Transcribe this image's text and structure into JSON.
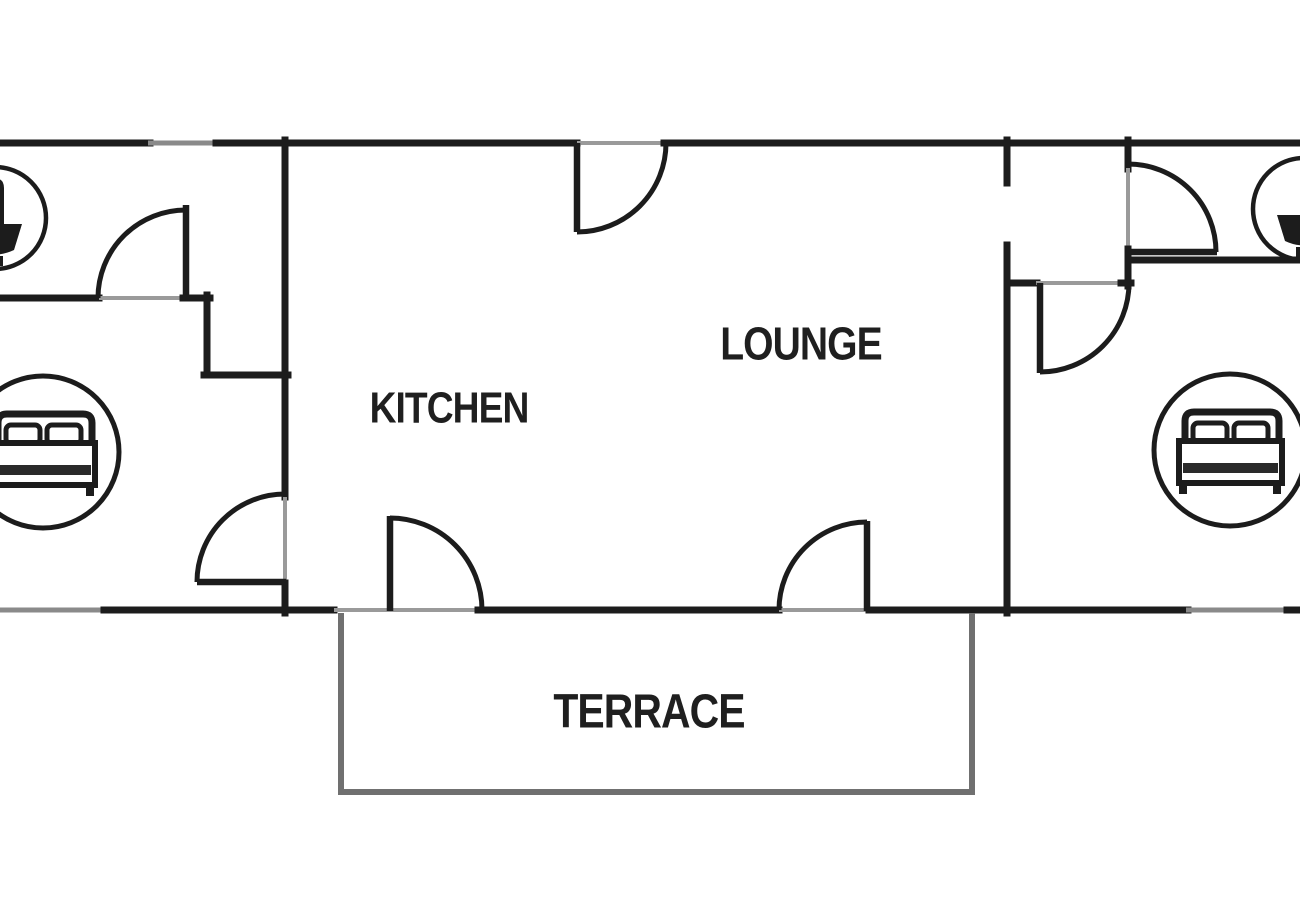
{
  "diagram": {
    "type": "apartment-floor-plan",
    "rooms": {
      "kitchen": {
        "label": "KITCHEN"
      },
      "lounge": {
        "label": "LOUNGE"
      },
      "terrace": {
        "label": "TERRACE"
      },
      "bedroom_left": {
        "icon": "double-bed-icon"
      },
      "bedroom_right": {
        "icon": "double-bed-icon"
      },
      "bathroom_left": {
        "icon": "washbasin-icon"
      },
      "bathroom_right": {
        "icon": "washbasin-icon"
      }
    },
    "counts": {
      "doors": 7,
      "windows": 3
    },
    "colors": {
      "wall": "#1c1c1c",
      "window": "#8a8a8a",
      "threshold": "#9a9a9a",
      "terrace_wall": "#707070",
      "background": "#ffffff",
      "label_text": "#1f1f1f"
    }
  }
}
